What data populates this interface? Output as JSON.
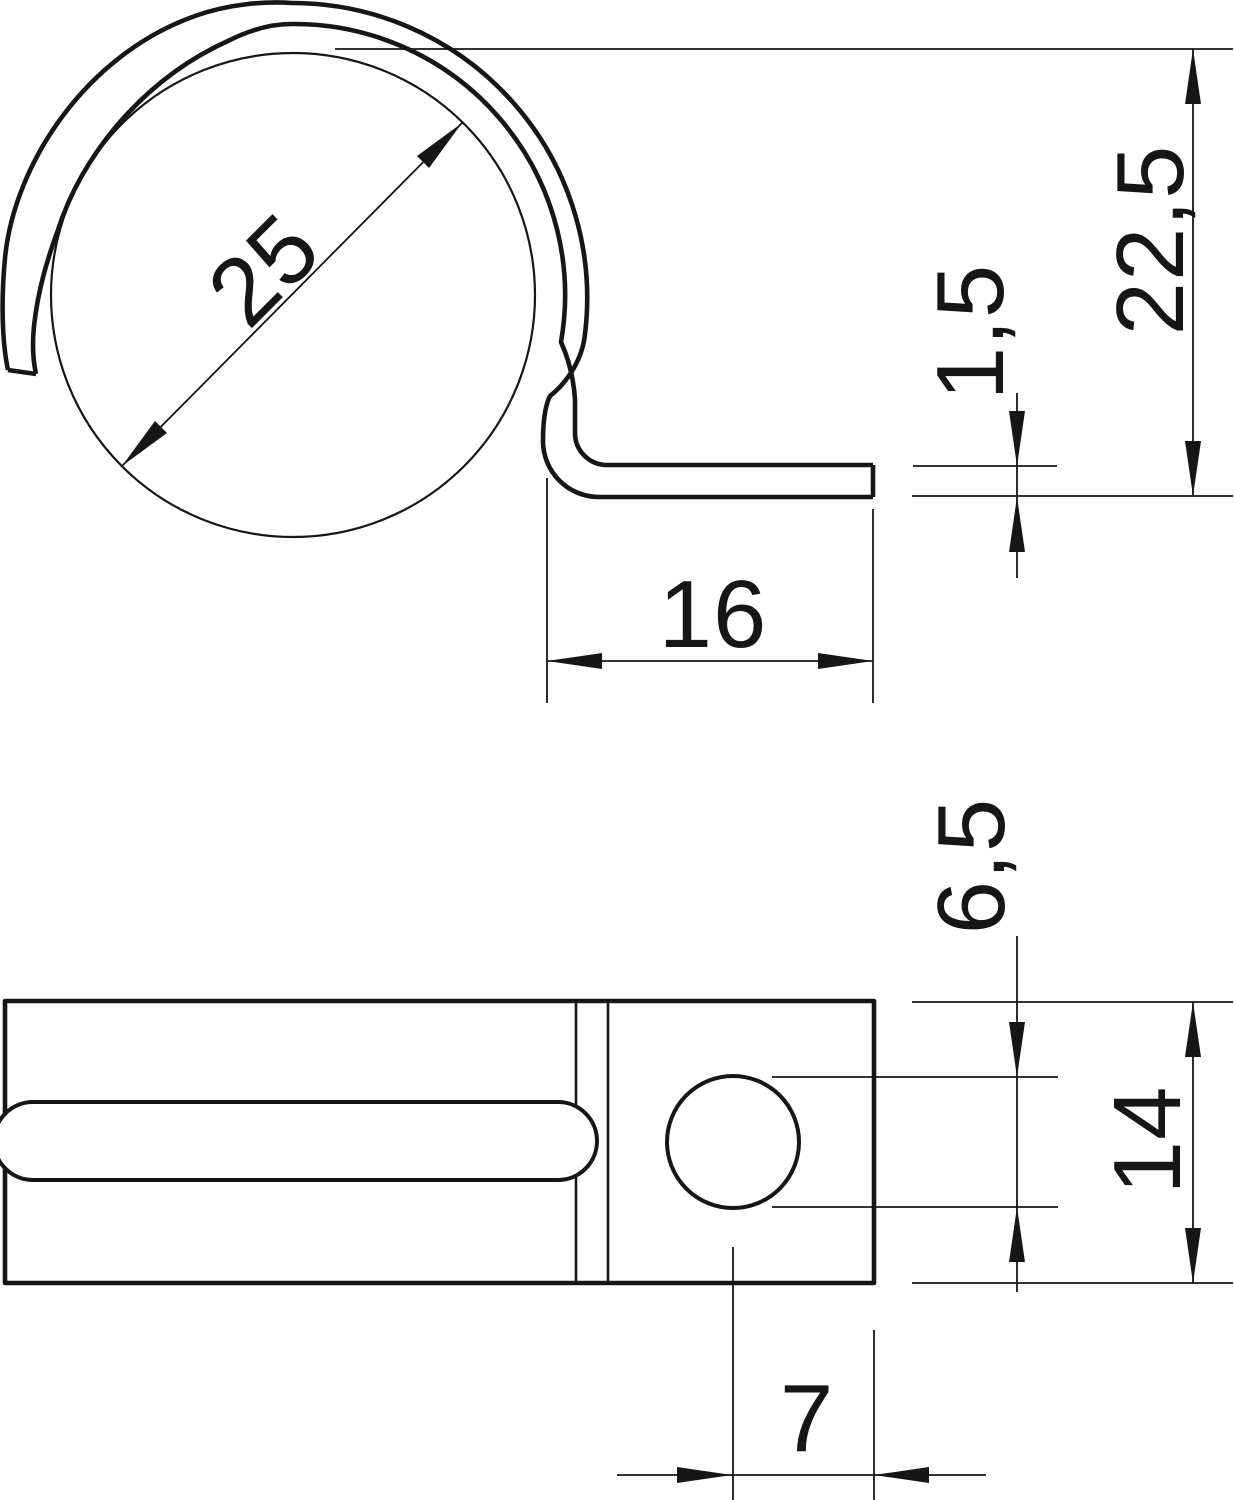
{
  "drawing": {
    "dimensions": {
      "clamp_diameter": "25",
      "overall_height": "22,5",
      "material_thickness": "1,5",
      "foot_length": "16",
      "hole_diameter": "6,5",
      "strap_width": "14",
      "hole_edge_offset": "7"
    }
  }
}
